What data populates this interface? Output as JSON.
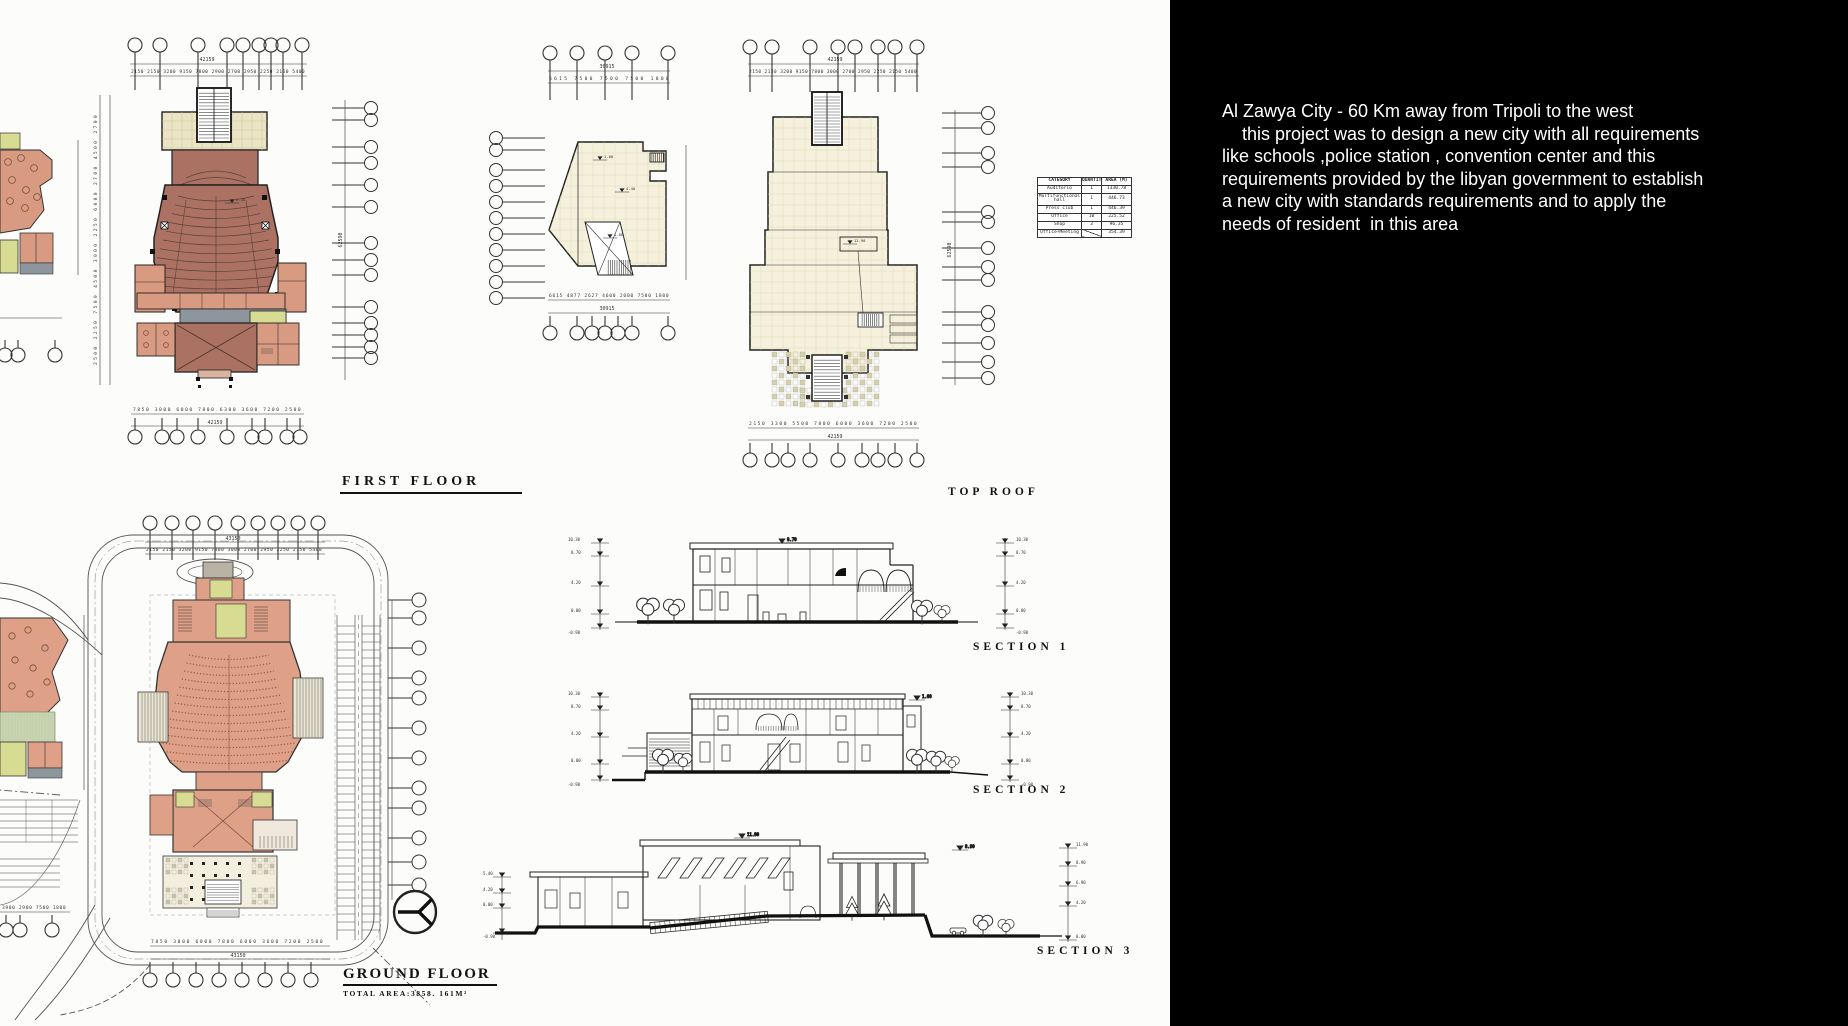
{
  "panel": {
    "description_lines": [
      "Al Zawya City - 60 Km away from Tripoli to the west",
      "    this project was to design a new city with all requirements",
      "like schools ,police station , convention center and this",
      "requirements provided by the libyan government to establish",
      "a new city with standards requirements and to apply the",
      "needs of resident  in this area"
    ]
  },
  "labels": {
    "first_floor": "FIRST FLOOR",
    "top_roof": "TOP ROOF",
    "ground_floor": "GROUND FLOOR",
    "total_area": "TOTAL AREA:3858. 161M²",
    "section1": "SECTION 1",
    "section2": "SECTION 2",
    "section3": "SECTION 3"
  },
  "area_table": {
    "headers": [
      "CATEGORY",
      "QUANTITY",
      "AREA (M)"
    ],
    "rows": [
      {
        "category": "Auditorio",
        "quantity": "1",
        "area": "1330.78"
      },
      {
        "category": "Multifunctional hall",
        "quantity": "1",
        "area": "446.73"
      },
      {
        "category": "Press club",
        "quantity": "1",
        "area": "446.39"
      },
      {
        "category": "Office",
        "quantity": "10",
        "area": "225.52"
      },
      {
        "category": "Shop",
        "quantity": "3",
        "area": "96.35"
      },
      {
        "category": "Office+Meeting",
        "quantity": "",
        "area": "354.39"
      }
    ]
  },
  "dims": {
    "ff_top_total": "42159",
    "ff_top_segs": "2150 2150 3200 9150 7800 2900 2700 2950 2250 2150 5400",
    "ff_bottom_segs": "7850 3000 6000 7800 6300 3600 7200 2500",
    "ff_bottom_total": "42159",
    "ff_left_segs": "2500 2250 7500 4500 3000 2250 6000 2700 4500 2700",
    "ff_right_total": "62590",
    "mid_top_total": "30915",
    "mid_top_segs": "6615 7500 7500 7500 1800",
    "mid_bottom_segs": "6615 4877 2627 4600 2000 7500 1800",
    "mid_bottom_total": "30915",
    "roof_top_total": "42159",
    "roof_top_segs": "2150 2150 3200 9150 7800 3000 2700 2950 2250 2150 5400",
    "roof_bottom_segs": "2150 3300 5500 7800 6000 3600 7200 2500",
    "roof_bottom_total": "42159",
    "roof_right_total": "62590",
    "gf_top_total": "43150",
    "gf_top_segs": "2150 2150 3200 9150 7800 3000 2700 2950 2250 2150 5400",
    "gf_bottom_segs": "7850 3000 6000 7800 6000 3600 7200 2500",
    "gf_bottom_total": "43150",
    "gf_left_segs": "3900 2900 7500 1800"
  },
  "plan_marks": {
    "a": "4.40",
    "b": "1.00",
    "c": "1.80",
    "d": "8.70",
    "e": "12.90",
    "f": "5.40"
  },
  "sections": {
    "s1_levels": [
      "10.30",
      "8.70",
      "4.20",
      "0.00",
      "-0.90"
    ],
    "s3_levels": [
      "11.90",
      "8.90",
      "6.90",
      "4.20",
      "0.00"
    ]
  },
  "colors": {
    "panel_bg": "#000000",
    "panel_text": "#ffffff",
    "auditorium": "#ab7264",
    "salmon": "#d89a80",
    "stage_beige": "#eae4c4",
    "roof_cream": "#f5f1dc",
    "corridor_gray": "#8e969d",
    "room_yellow": "#d8dc92",
    "site_salmon": "#dfa088",
    "site_green": "#c9d4b2"
  }
}
